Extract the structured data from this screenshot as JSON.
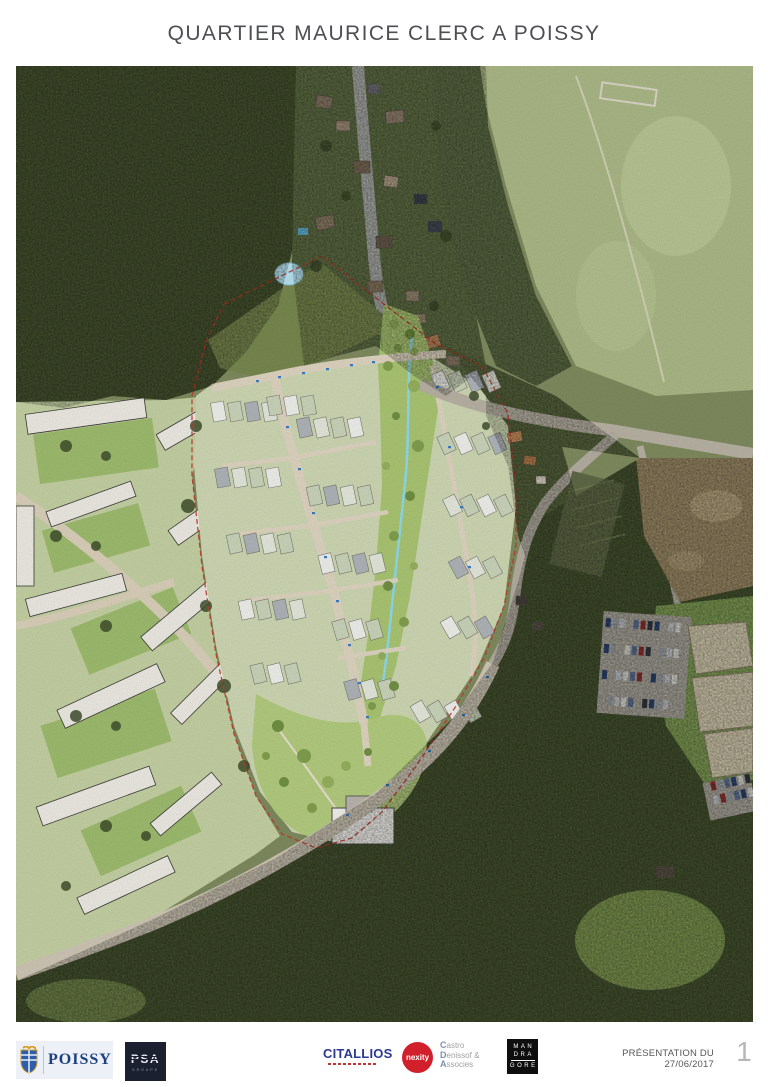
{
  "page": {
    "title": "QUARTIER MAURICE CLERC A POISSY"
  },
  "map": {
    "description": "Vue aérienne de Poissy avec plan masse du projet du quartier Maurice Clerc",
    "labels": {
      "cour_entree": "Cour d'entrée"
    }
  },
  "footer": {
    "poissy": {
      "name": "POISSY"
    },
    "psa": {
      "name": "PSA",
      "group": "GROUPE"
    },
    "citallios": {
      "name": "CITALLIOS"
    },
    "nexity": {
      "name": "nexity"
    },
    "castro": {
      "l1_initial": "C",
      "l1_rest": "astro",
      "l2_initial": "D",
      "l2_rest": "enissof &",
      "l3_initial": "A",
      "l3_rest": "ssocies"
    },
    "mandragore": {
      "l1": "MAN",
      "l2": "DRA",
      "l3": "GORE"
    },
    "presentation_date": "PRÉSENTATION DU 27/06/2017",
    "page_number": "1"
  },
  "colors": {
    "forest_dark": "#46532f",
    "scrub": "#5f6e45",
    "meadow": "#a9b685",
    "urban_wash": "#c3cfa2",
    "plan_green": "#a9c472",
    "park_green": "#b2ca7e",
    "stream_blue": "#8fd9e9",
    "road_gray": "#b7b1a3",
    "road_beige": "#ddd3bf",
    "boundary_red": "#c0392b",
    "dirt_brown": "#9b8a66",
    "poissy_blue": "#1c3f80",
    "nexity_red": "#d1202c",
    "citallios_blue": "#2b3990",
    "psa_navy": "#1b2030",
    "title_gray": "#4d4f52"
  }
}
